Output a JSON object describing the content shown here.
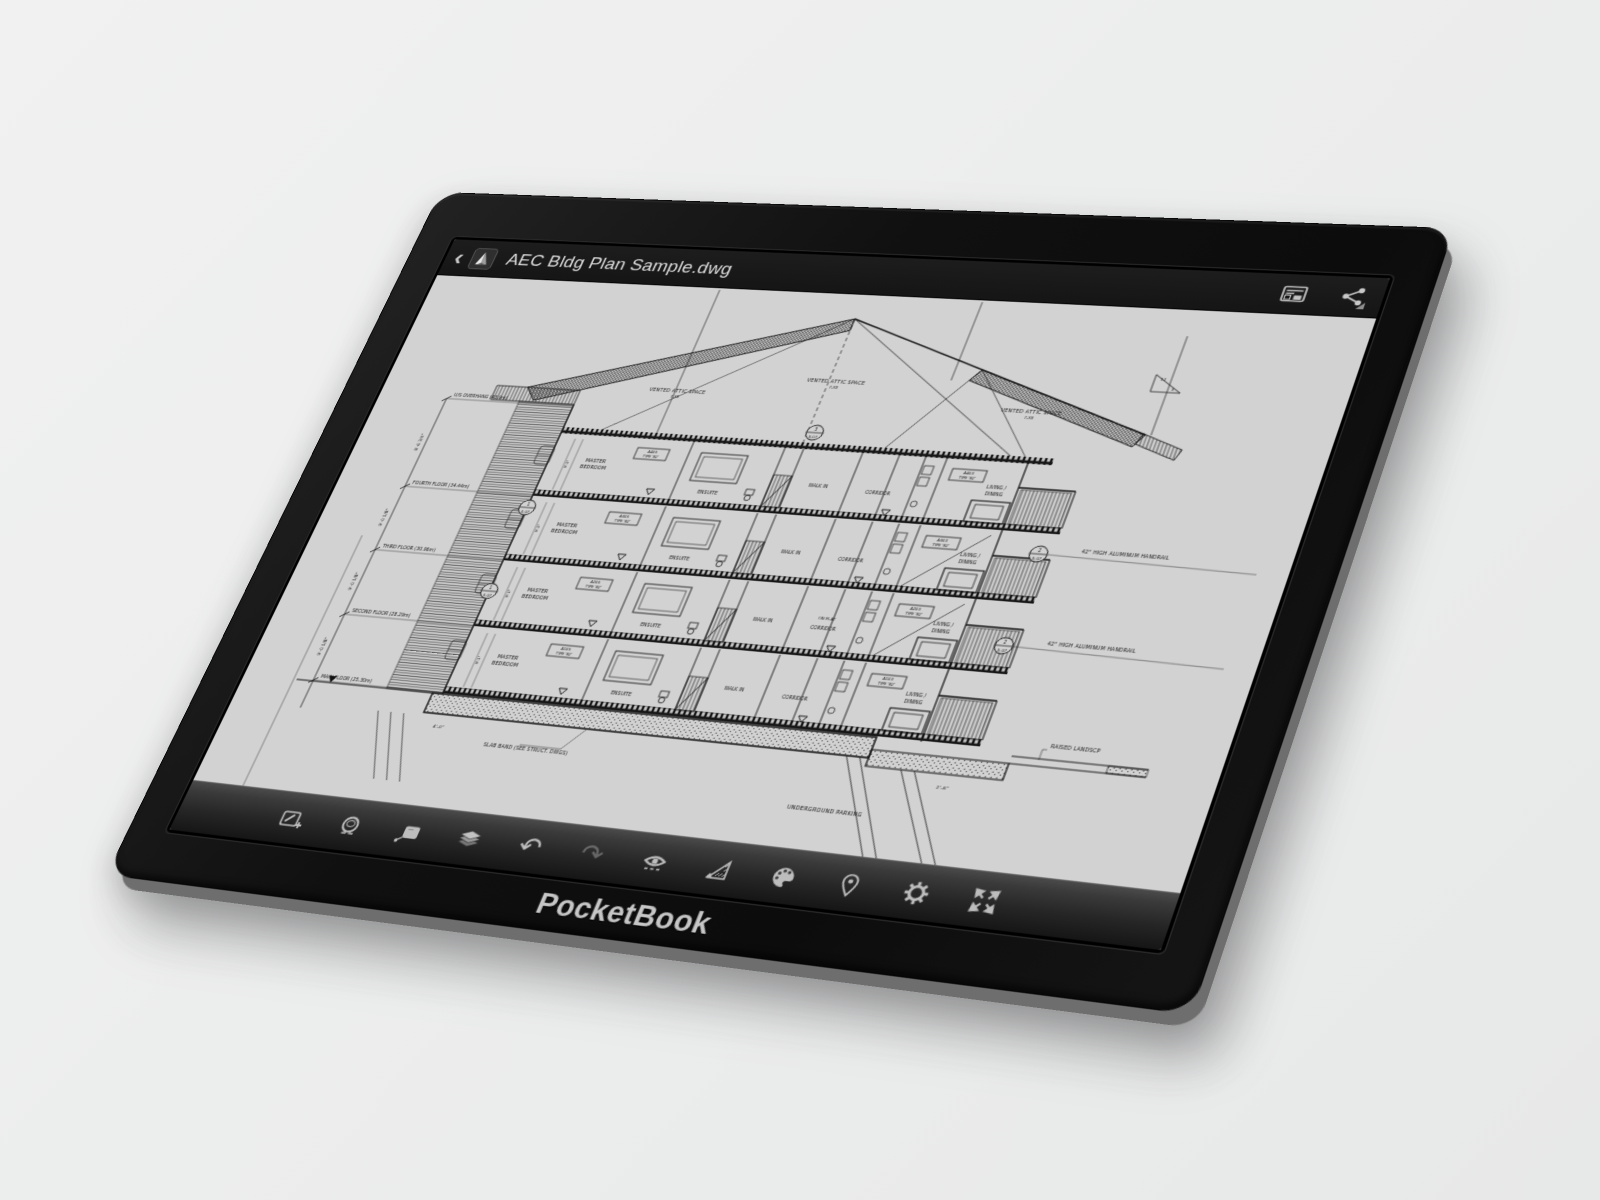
{
  "page": {
    "background": "#ececec"
  },
  "device": {
    "brand": "PocketBook",
    "body_color": "#101010",
    "rim_color": "#6e6e6e",
    "screen_color": "#d2d2d2"
  },
  "app": {
    "title_bar": {
      "back_glyph": "‹",
      "title": "AEC Bldg Plan Sample.dwg",
      "right_icons": [
        {
          "name": "sheet-preview-icon",
          "label": "Sheet preview"
        },
        {
          "name": "share-icon",
          "label": "Share"
        }
      ]
    },
    "toolbar": {
      "items": [
        {
          "name": "annotate-add-icon",
          "label": "Add annotation"
        },
        {
          "name": "loupe-icon",
          "label": "Loupe"
        },
        {
          "name": "note-icon",
          "label": "Note"
        },
        {
          "name": "layers-icon",
          "label": "Layers"
        },
        {
          "name": "undo-icon",
          "label": "Undo",
          "glyph": "↶"
        },
        {
          "name": "redo-icon",
          "label": "Redo",
          "glyph": "↷",
          "disabled": true
        },
        {
          "name": "visibility-icon",
          "label": "Visibility"
        },
        {
          "name": "measure-icon",
          "label": "Measure"
        },
        {
          "name": "palette-icon",
          "label": "Palette"
        },
        {
          "name": "pin-icon",
          "label": "Location pin"
        },
        {
          "name": "settings-icon",
          "label": "Settings"
        },
        {
          "name": "fullscreen-icon",
          "label": "Fullscreen"
        }
      ]
    }
  },
  "drawing": {
    "type": "architectural building cross-section",
    "attic_labels": [
      {
        "t": "VENTED ATTIC SPACE",
        "sub": "7-XX",
        "x": 302,
        "y": 118
      },
      {
        "t": "VENTED ATTIC SPACE",
        "sub": "7-XX",
        "x": 452,
        "y": 98
      },
      {
        "t": "VENTED ATTIC SPACE",
        "sub": "7-XX",
        "x": 645,
        "y": 118
      }
    ],
    "floors": [
      {
        "left_tag1": "A405",
        "left_tag2": "TYPE 'B2'",
        "right_tag1": "A403",
        "right_tag2": "TYPE 'B2'",
        "master1": "MASTER",
        "master2": "BEDROOM",
        "ensuite": "ENSUITE",
        "walkin": "WALK IN",
        "corridor": "CORRIDOR",
        "living1": "LIVING /",
        "living2": "DINING",
        "on_flat": ""
      },
      {
        "left_tag1": "A305",
        "left_tag2": "TYPE 'B2'",
        "right_tag1": "A303",
        "right_tag2": "TYPE 'B2'",
        "master1": "MASTER",
        "master2": "BEDROOM",
        "ensuite": "ENSUITE",
        "walkin": "WALK IN",
        "corridor": "CORRIDOR",
        "living1": "LIVING /",
        "living2": "DINING",
        "on_flat": ""
      },
      {
        "left_tag1": "A205",
        "left_tag2": "TYPE 'B2'",
        "right_tag1": "A203",
        "right_tag2": "TYPE 'B2'",
        "master1": "MASTER",
        "master2": "BEDROOM",
        "ensuite": "ENSUITE",
        "walkin": "WALK IN",
        "corridor": "CORRIDOR",
        "living1": "LIVING /",
        "living2": "DINING",
        "on_flat": "ON FLAT"
      },
      {
        "left_tag1": "A105",
        "left_tag2": "TYPE 'B2'",
        "right_tag1": "A103",
        "right_tag2": "TYPE 'B2'",
        "master1": "MASTER",
        "master2": "BEDROOM",
        "ensuite": "ENSUITE",
        "walkin": "WALK IN",
        "corridor": "CORRIDOR",
        "living1": "LIVING /",
        "living2": "DINING",
        "on_flat": ""
      }
    ],
    "elevations": [
      {
        "label": "U/S OVERHANG (43.9m)",
        "y": 140
      },
      {
        "label": "FOURTH FLOOR (34.44m)",
        "y": 239
      },
      {
        "label": "THIRD FLOOR (30.96m)",
        "y": 309
      },
      {
        "label": "SECOND FLOOR (28.29m)",
        "y": 379
      },
      {
        "label": "MAIN FLOOR (25.30m)",
        "y": 449
      }
    ],
    "dims": [
      {
        "t": "8'-6 3/4\"",
        "y": 190
      },
      {
        "t": "9'-0 1/8\"",
        "y": 274
      },
      {
        "t": "9'-0 1/8\"",
        "y": 344
      },
      {
        "t": "9'-0 1/8\"",
        "y": 414
      }
    ],
    "room_dim": "9'-1\"",
    "annotations": [
      {
        "t": "42\" HIGH ALUMINUM HANDRAIL",
        "x": 737,
        "y": 256,
        "s": 4.6
      },
      {
        "t": "42\" HIGH ALUMINUM HANDRAIL",
        "x": 737,
        "y": 348,
        "s": 4.6
      },
      {
        "t": "RAISED LANDSCP",
        "x": 772,
        "y": 444,
        "s": 4.6
      },
      {
        "t": "SLAB BAND (SEE STRUCT. DWGS)",
        "x": 266,
        "y": 497,
        "s": 4.6
      },
      {
        "t": "UNDERGROUND PARKING",
        "x": 566,
        "y": 525,
        "s": 5
      },
      {
        "t": "4'-0\"",
        "x": 210,
        "y": 484,
        "s": 4.2
      },
      {
        "t": "2'-6\"",
        "x": 688,
        "y": 492,
        "s": 4.2
      },
      {
        "t": "12",
        "x": 750,
        "y": 76,
        "s": 4
      },
      {
        "t": "3",
        "x": 763,
        "y": 86,
        "s": 4
      }
    ],
    "callouts": [
      {
        "t": "3",
        "b": "5.07",
        "x": 452,
        "y": 152
      },
      {
        "t": "2",
        "b": "5.07",
        "x": 700,
        "y": 260
      },
      {
        "t": "2",
        "b": "5.07",
        "x": 700,
        "y": 352
      },
      {
        "t": "1",
        "b": "5.07",
        "x": 205,
        "y": 252
      },
      {
        "t": "1",
        "b": "5.07",
        "x": 205,
        "y": 342
      }
    ]
  }
}
